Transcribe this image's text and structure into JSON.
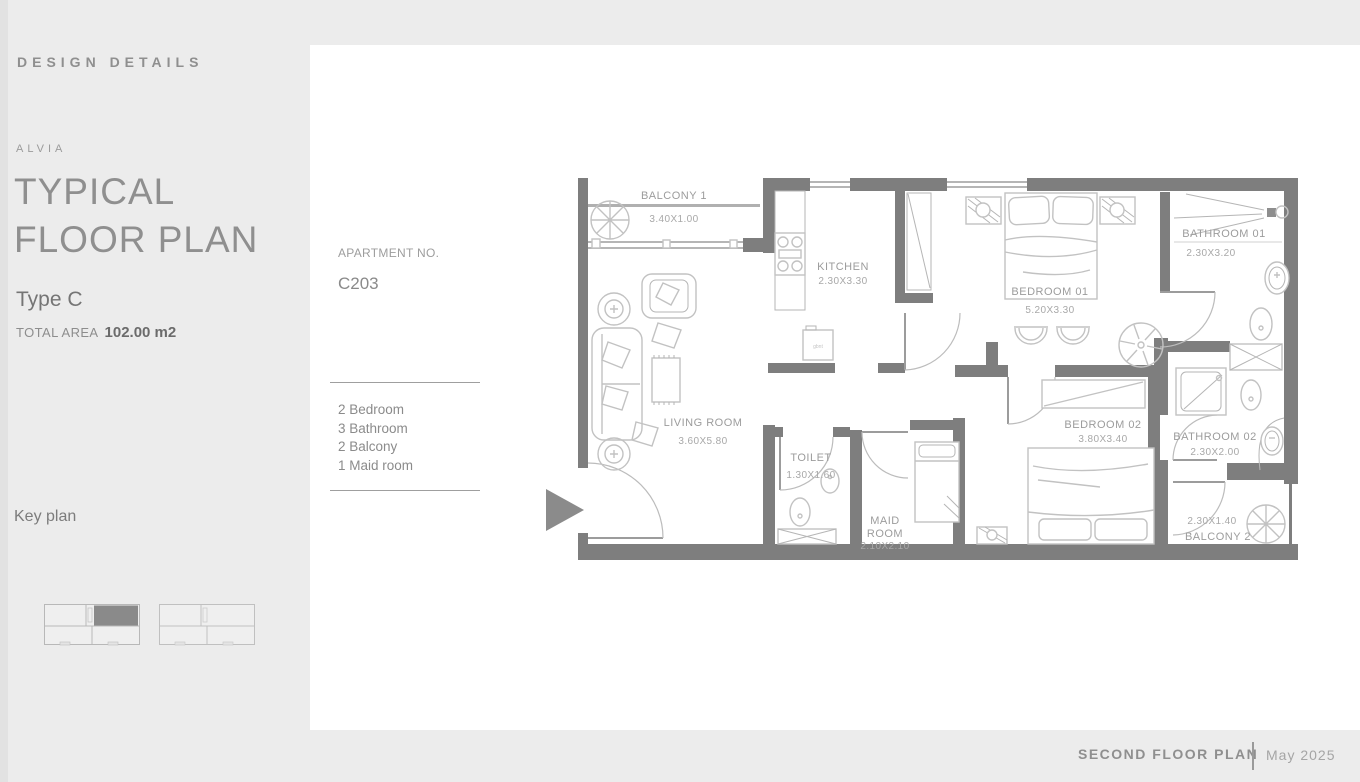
{
  "sidebar": {
    "section_label": "DESIGN DETAILS",
    "brand": "ALVIA",
    "title_line1": "TYPICAL",
    "title_line2": "FLOOR PLAN",
    "unit_type": "Type C",
    "total_area_label": "TOTAL AREA",
    "total_area_value": "102.00 m2",
    "key_plan_label": "Key plan"
  },
  "apartment": {
    "label": "APARTMENT NO.",
    "number": "C203",
    "features": [
      "2 Bedroom",
      "3 Bathroom",
      "2 Balcony",
      "1 Maid room"
    ]
  },
  "floor_plan": {
    "rooms": [
      {
        "name": "BALCONY 1",
        "dims": "3.40X1.00"
      },
      {
        "name": "KITCHEN",
        "dims": "2.30X3.30"
      },
      {
        "name": "BEDROOM 01",
        "dims": "5.20X3.30"
      },
      {
        "name": "BATHROOM 01",
        "dims": "2.30X3.20"
      },
      {
        "name": "LIVING ROOM",
        "dims": "3.60X5.80"
      },
      {
        "name": "TOILET",
        "dims": "1.30X1.60"
      },
      {
        "name": "MAID ROOM",
        "name_lines": [
          "MAID",
          "ROOM"
        ],
        "dims": "2.10X2.10"
      },
      {
        "name": "BEDROOM 02",
        "dims": "3.80X3.40"
      },
      {
        "name": "BATHROOM 02",
        "dims": "2.30X2.00"
      },
      {
        "name": "BALCONY 2",
        "dims": "2.30X1.40"
      }
    ],
    "appliance_label": "gbnt"
  },
  "footer": {
    "plan_label": "SECOND FLOOR PLAN",
    "date": "May 2025"
  },
  "colors": {
    "wall": "#7e7e7e",
    "furniture": "#c2c2c2",
    "accent": "#8a8a8a",
    "page_bg": "#ececec",
    "panel_bg": "#ffffff"
  }
}
